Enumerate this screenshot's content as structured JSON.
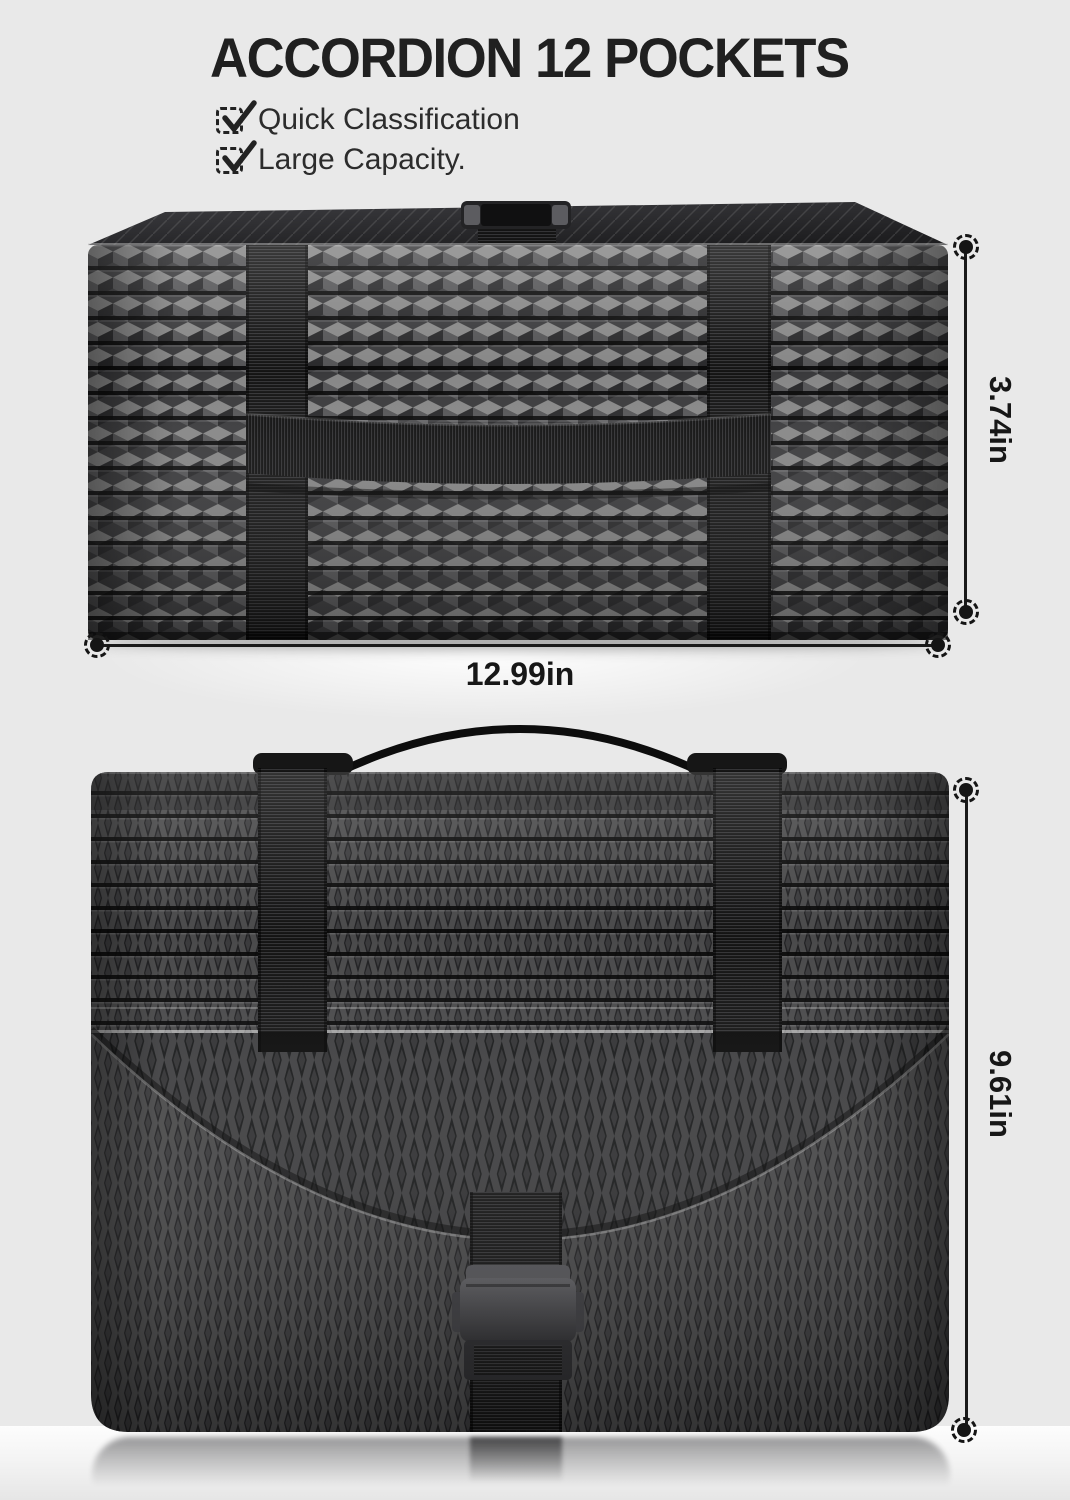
{
  "title": "ACCORDION 12 POCKETS",
  "features": [
    {
      "icon": "checkbox-checked-icon",
      "label": "Quick Classification"
    },
    {
      "icon": "checkbox-checked-icon",
      "label": "Large Capacity."
    }
  ],
  "dimensions": [
    {
      "name": "depth",
      "label": "3.74in",
      "orientation": "vertical"
    },
    {
      "name": "width",
      "label": "12.99in",
      "orientation": "horizontal"
    },
    {
      "name": "height",
      "label": "9.61in",
      "orientation": "vertical"
    }
  ],
  "product_views": [
    {
      "name": "closed-top-view",
      "description_icon": "expanding-file-closed"
    },
    {
      "name": "front-flap-view",
      "description_icon": "expanding-file-front"
    }
  ],
  "colors": {
    "background": "#e9e9e9",
    "floor_highlight": "#fdfdfd",
    "title_ink": "#202020",
    "dimension_ink": "#171717",
    "bag_dark": "#232325",
    "bag_mid": "#4a4a4c",
    "strap_black": "#131313",
    "buckle_gray": "#57575b"
  }
}
